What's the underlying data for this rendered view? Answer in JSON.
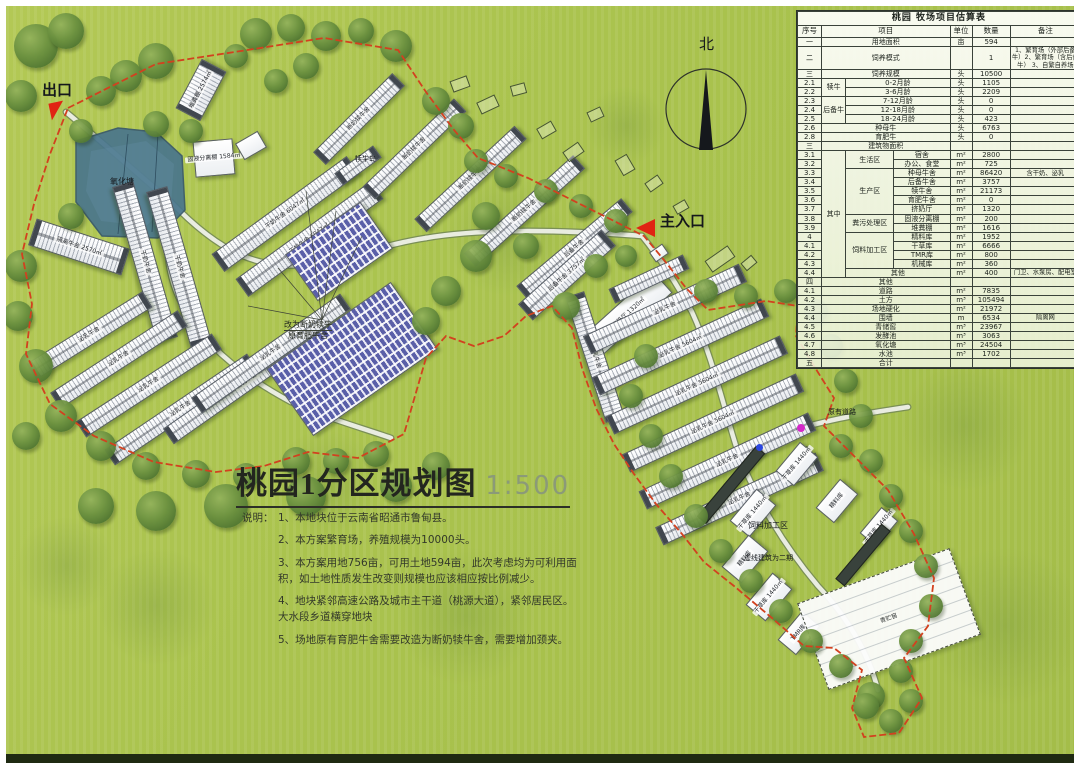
{
  "colors": {
    "boundary": "#d2411f",
    "pond": "#49758c",
    "background": "#a9c24c",
    "marker_red": "#e02413",
    "marker_magenta": "#d428c8",
    "marker_blue": "#2b46e0"
  },
  "title_block": {
    "title": "桃园1分区规划图",
    "scale": "1:500",
    "notes_label": "说明：",
    "notes": [
      "1、本地块位于云南省昭通市鲁甸县。",
      "2、本方案繁育场，养殖规模为10000头。",
      "3、本方案用地756亩，可用土地594亩，此次考虑均为可利用面积，如土地性质发生改变则规模也应该相应按比例减少。",
      "4、地块紧邻高速公路及城市主干道（桃源大道），紧邻居民区。\n大水段乡道横穿地块",
      "5、场地原有育肥牛舍需要改造为断奶犊牛舍，需要增加颈夹。"
    ]
  },
  "estimate_table": {
    "title": "桃园 牧场项目估算表",
    "headers": [
      "序号",
      "项目",
      "单位",
      "数量",
      "备注"
    ],
    "rows": [
      {
        "no": "一",
        "cells": [
          [
            "用地面积",
            3,
            1
          ]
        ],
        "unit": "亩",
        "qty": "594",
        "note": ""
      },
      {
        "no": "二",
        "cells": [
          [
            "饲养模式",
            3,
            1
          ]
        ],
        "unit": "",
        "qty": "1",
        "note": "1、繁育场（外部后备牛）2、繁育场（含后备牛） 3、自繁自养场"
      },
      {
        "no": "三",
        "cells": [
          [
            "饲养规模",
            3,
            1
          ]
        ],
        "unit": "头",
        "qty": "10500",
        "note": ""
      },
      {
        "no": "2.1",
        "cells": [
          [
            "犊牛",
            1,
            2
          ],
          [
            "0-2月龄",
            2,
            1
          ]
        ],
        "unit": "头",
        "qty": "1105",
        "note": ""
      },
      {
        "no": "2.2",
        "cells": [
          [
            "3-6月龄",
            2,
            1
          ]
        ],
        "unit": "头",
        "qty": "2209",
        "note": ""
      },
      {
        "no": "2.3",
        "cells": [
          [
            "后备牛",
            1,
            3
          ],
          [
            "7-12月龄",
            2,
            1
          ]
        ],
        "unit": "头",
        "qty": "0",
        "note": ""
      },
      {
        "no": "2.4",
        "cells": [
          [
            "12-18月龄",
            2,
            1
          ]
        ],
        "unit": "头",
        "qty": "0",
        "note": ""
      },
      {
        "no": "2.5",
        "cells": [
          [
            "18-24月龄",
            2,
            1
          ]
        ],
        "unit": "头",
        "qty": "423",
        "note": ""
      },
      {
        "no": "2.6",
        "cells": [
          [
            "种母牛",
            3,
            1
          ]
        ],
        "unit": "头",
        "qty": "6763",
        "note": ""
      },
      {
        "no": "2.8",
        "cells": [
          [
            "育肥牛",
            3,
            1
          ]
        ],
        "unit": "头",
        "qty": "0",
        "note": ""
      },
      {
        "no": "三",
        "cells": [
          [
            "建筑物面积",
            3,
            1
          ]
        ],
        "unit": "",
        "qty": "",
        "note": ""
      },
      {
        "no": "3.1",
        "cells": [
          [
            "其中",
            1,
            14
          ],
          [
            "生活区",
            1,
            2
          ],
          [
            "宿舍",
            1,
            1
          ]
        ],
        "unit": "m²",
        "qty": "2800",
        "note": ""
      },
      {
        "no": "3.2",
        "cells": [
          [
            "办公、食堂",
            1,
            1
          ]
        ],
        "unit": "m²",
        "qty": "725",
        "note": ""
      },
      {
        "no": "3.3",
        "cells": [
          [
            "生产区",
            1,
            5
          ],
          [
            "种母牛舍",
            1,
            1
          ]
        ],
        "unit": "m²",
        "qty": "86420",
        "note": "含干奶、泌乳"
      },
      {
        "no": "3.4",
        "cells": [
          [
            "后备牛舍",
            1,
            1
          ]
        ],
        "unit": "m²",
        "qty": "3757",
        "note": ""
      },
      {
        "no": "3.5",
        "cells": [
          [
            "犊牛舍",
            1,
            1
          ]
        ],
        "unit": "m²",
        "qty": "21173",
        "note": ""
      },
      {
        "no": "3.6",
        "cells": [
          [
            "育肥牛舍",
            1,
            1
          ]
        ],
        "unit": "m²",
        "qty": "0",
        "note": ""
      },
      {
        "no": "3.7",
        "cells": [
          [
            "挤奶厅",
            1,
            1
          ]
        ],
        "unit": "m²",
        "qty": "1320",
        "note": ""
      },
      {
        "no": "3.8",
        "cells": [
          [
            "粪污处理区",
            1,
            2
          ],
          [
            "固液分离棚",
            1,
            1
          ]
        ],
        "unit": "m²",
        "qty": "200",
        "note": ""
      },
      {
        "no": "3.9",
        "cells": [
          [
            "堆粪棚",
            1,
            1
          ]
        ],
        "unit": "m²",
        "qty": "1616",
        "note": ""
      },
      {
        "no": "4",
        "cells": [
          [
            "饲料加工区",
            1,
            4
          ],
          [
            "精料库",
            1,
            1
          ]
        ],
        "unit": "m²",
        "qty": "1952",
        "note": ""
      },
      {
        "no": "4.1",
        "cells": [
          [
            "干草库",
            1,
            1
          ]
        ],
        "unit": "m²",
        "qty": "6666",
        "note": ""
      },
      {
        "no": "4.2",
        "cells": [
          [
            "TMR库",
            1,
            1
          ]
        ],
        "unit": "m²",
        "qty": "800",
        "note": ""
      },
      {
        "no": "4.3",
        "cells": [
          [
            "机械库",
            1,
            1
          ]
        ],
        "unit": "m²",
        "qty": "360",
        "note": ""
      },
      {
        "no": "4.4",
        "cells": [
          [
            "其他",
            2,
            1
          ]
        ],
        "unit": "m²",
        "qty": "400",
        "note": "门卫、水泵房、配电室"
      },
      {
        "no": "四",
        "cells": [
          [
            "其他",
            3,
            1
          ]
        ],
        "unit": "",
        "qty": "",
        "note": ""
      },
      {
        "no": "4.1",
        "cells": [
          [
            "道路",
            3,
            1
          ]
        ],
        "unit": "m²",
        "qty": "7835",
        "note": ""
      },
      {
        "no": "4.2",
        "cells": [
          [
            "土方",
            3,
            1
          ]
        ],
        "unit": "m³",
        "qty": "105494",
        "note": ""
      },
      {
        "no": "4.3",
        "cells": [
          [
            "场地硬化",
            3,
            1
          ]
        ],
        "unit": "m²",
        "qty": "21972",
        "note": ""
      },
      {
        "no": "4.4",
        "cells": [
          [
            "围墙",
            3,
            1
          ]
        ],
        "unit": "m",
        "qty": "6534",
        "note": "隔离网"
      },
      {
        "no": "4.5",
        "cells": [
          [
            "青储窖",
            3,
            1
          ]
        ],
        "unit": "m³",
        "qty": "23967",
        "note": ""
      },
      {
        "no": "4.6",
        "cells": [
          [
            "发酵池",
            3,
            1
          ]
        ],
        "unit": "m³",
        "qty": "3063",
        "note": ""
      },
      {
        "no": "4.7",
        "cells": [
          [
            "氧化塘",
            3,
            1
          ]
        ],
        "unit": "m³",
        "qty": "24504",
        "note": ""
      },
      {
        "no": "4.8",
        "cells": [
          [
            "水池",
            3,
            1
          ]
        ],
        "unit": "m³",
        "qty": "1702",
        "note": ""
      },
      {
        "no": "五",
        "cells": [
          [
            "合计",
            3,
            1
          ]
        ],
        "unit": "",
        "qty": "",
        "note": ""
      }
    ]
  },
  "map": {
    "labels": [
      {
        "name": "exit-label",
        "text": "出口",
        "x": 36,
        "y": 76,
        "fs": 15,
        "bold": true
      },
      {
        "name": "main-entrance-label",
        "text": "主入口",
        "x": 654,
        "y": 207,
        "fs": 15,
        "bold": true
      },
      {
        "name": "north-label",
        "text": "北",
        "x": 693,
        "y": 30,
        "fs": 15,
        "bold": false
      },
      {
        "name": "pond-label",
        "text": "氧化塘",
        "x": 104,
        "y": 172,
        "fs": 8,
        "bold": false
      },
      {
        "name": "calf-island-label",
        "text": "犊牛岛",
        "x": 349,
        "y": 150,
        "fs": 7,
        "bold": false
      },
      {
        "name": "existing-road-label",
        "text": "原有道路",
        "x": 822,
        "y": 403,
        "fs": 7,
        "bold": false
      },
      {
        "name": "feed-area-label",
        "text": "饲料加工区",
        "x": 742,
        "y": 516,
        "fs": 8,
        "bold": false
      },
      {
        "name": "phase2-label",
        "text": "虚线建筑为二期",
        "x": 738,
        "y": 549,
        "fs": 7,
        "bold": false
      }
    ],
    "annotation": {
      "line1": "改为断奶犊牛",
      "line2": "原育肥牛舍",
      "x": 278,
      "y": 314
    },
    "buildings": [
      {
        "x": 167,
        "y": 70,
        "w": 54,
        "h": 26,
        "r": -62,
        "s": "barn",
        "l": "堆粪棚 2574㎡"
      },
      {
        "x": 188,
        "y": 134,
        "w": 38,
        "h": 34,
        "r": -5,
        "s": "plain",
        "l": "固液分离棚 1584㎡"
      },
      {
        "x": 232,
        "y": 130,
        "w": 24,
        "h": 17,
        "r": -30,
        "s": "plain",
        "l": ""
      },
      {
        "x": 196,
        "y": 197,
        "w": 165,
        "h": 20,
        "r": -36,
        "s": "barn",
        "l": "干奶牛舍 6047㎡"
      },
      {
        "x": 220,
        "y": 222,
        "w": 165,
        "h": 20,
        "r": -36,
        "s": "barn",
        "l": "干奶牛舍 6047㎡"
      },
      {
        "x": 328,
        "y": 152,
        "w": 46,
        "h": 13,
        "r": -36,
        "s": "barn",
        "l": ""
      },
      {
        "x": 24,
        "y": 227,
        "w": 96,
        "h": 26,
        "r": 18,
        "s": "barn",
        "l": "隔离牛舍 2570㎡"
      },
      {
        "x": 58,
        "y": 245,
        "w": 160,
        "h": 20,
        "r": 74,
        "s": "barn",
        "l": "干奶牛舍"
      },
      {
        "x": 92,
        "y": 250,
        "w": 160,
        "h": 20,
        "r": 74,
        "s": "barn",
        "l": "干奶牛舍"
      },
      {
        "x": 15,
        "y": 320,
        "w": 135,
        "h": 17,
        "r": -32,
        "s": "barn",
        "l": "泌乳牛舍"
      },
      {
        "x": 37,
        "y": 344,
        "w": 150,
        "h": 17,
        "r": -33,
        "s": "barn",
        "l": "泌乳牛舍"
      },
      {
        "x": 62,
        "y": 370,
        "w": 160,
        "h": 17,
        "r": -33,
        "s": "barn",
        "l": "泌乳牛舍"
      },
      {
        "x": 89,
        "y": 394,
        "w": 170,
        "h": 17,
        "r": -34,
        "s": "barn",
        "l": "泌乳牛舍"
      },
      {
        "x": 145,
        "y": 366,
        "w": 190,
        "h": 17,
        "r": -35,
        "s": "barn",
        "l": "泌乳牛舍"
      },
      {
        "x": 174,
        "y": 338,
        "w": 180,
        "h": 17,
        "r": -35,
        "s": "barn",
        "l": "泌乳牛舍"
      },
      {
        "x": 270,
        "y": 312,
        "w": 150,
        "h": 80,
        "r": -35,
        "s": "hutch",
        "l": ""
      },
      {
        "x": 287,
        "y": 217,
        "w": 90,
        "h": 55,
        "r": -35,
        "s": "hutch",
        "l": ""
      },
      {
        "x": 297,
        "y": 104,
        "w": 110,
        "h": 16,
        "r": -45,
        "s": "barn",
        "l": "断奶犊牛舍"
      },
      {
        "x": 345,
        "y": 134,
        "w": 125,
        "h": 16,
        "r": -44,
        "s": "barn",
        "l": "断奶犊牛舍"
      },
      {
        "x": 396,
        "y": 164,
        "w": 135,
        "h": 16,
        "r": -43,
        "s": "barn",
        "l": "断奶犊牛舍"
      },
      {
        "x": 445,
        "y": 196,
        "w": 145,
        "h": 16,
        "r": -42,
        "s": "barn",
        "l": "断奶犊牛舍"
      },
      {
        "x": 500,
        "y": 234,
        "w": 135,
        "h": 16,
        "r": -40,
        "s": "barn",
        "l": "后备牛舍"
      },
      {
        "x": 505,
        "y": 258,
        "w": 110,
        "h": 20,
        "r": -42,
        "s": "barn",
        "l": "后备牛舍 3757㎡"
      },
      {
        "x": 577,
        "y": 293,
        "w": 90,
        "h": 26,
        "r": -42,
        "s": "plain",
        "l": "挤奶厅 1320㎡"
      },
      {
        "x": 645,
        "y": 241,
        "w": 14,
        "h": 10,
        "r": -35,
        "s": "plain",
        "l": ""
      },
      {
        "x": 523,
        "y": 341,
        "w": 130,
        "h": 18,
        "r": 72,
        "s": "barn",
        "l": "泌乳牛舍"
      },
      {
        "x": 602,
        "y": 265,
        "w": 80,
        "h": 14,
        "r": -25,
        "s": "barn",
        "l": ""
      },
      {
        "x": 573,
        "y": 293,
        "w": 170,
        "h": 18,
        "r": -25,
        "s": "barn",
        "l": "泌乳牛舍"
      },
      {
        "x": 581,
        "y": 331,
        "w": 185,
        "h": 18,
        "r": -25,
        "s": "barn",
        "l": "泌乳牛舍 5604㎡"
      },
      {
        "x": 595,
        "y": 369,
        "w": 190,
        "h": 18,
        "r": -25,
        "s": "barn",
        "l": "泌乳牛舍 5604㎡"
      },
      {
        "x": 611,
        "y": 407,
        "w": 190,
        "h": 18,
        "r": -25,
        "s": "barn",
        "l": "泌乳牛舍 5604㎡"
      },
      {
        "x": 628,
        "y": 445,
        "w": 185,
        "h": 18,
        "r": -25,
        "s": "barn",
        "l": "泌乳牛舍"
      },
      {
        "x": 645,
        "y": 483,
        "w": 175,
        "h": 18,
        "r": -25,
        "s": "barn",
        "l": "泌乳牛舍"
      },
      {
        "x": 772,
        "y": 446,
        "w": 36,
        "h": 22,
        "r": -50,
        "s": "plain",
        "l": "干草库 1440㎡"
      },
      {
        "x": 812,
        "y": 483,
        "w": 36,
        "h": 22,
        "r": -50,
        "s": "plain",
        "l": "精料库"
      },
      {
        "x": 856,
        "y": 510,
        "w": 32,
        "h": 20,
        "r": -50,
        "s": "plain",
        "l": "干草库 1440㎡"
      },
      {
        "x": 726,
        "y": 494,
        "w": 40,
        "h": 24,
        "r": -50,
        "s": "plain",
        "l": "干草库 1440㎡"
      },
      {
        "x": 718,
        "y": 540,
        "w": 40,
        "h": 24,
        "r": -50,
        "s": "plain",
        "l": "精料库"
      },
      {
        "x": 742,
        "y": 578,
        "w": 40,
        "h": 24,
        "r": -50,
        "s": "plain",
        "l": "干草库 1440㎡"
      },
      {
        "x": 774,
        "y": 615,
        "w": 36,
        "h": 22,
        "r": -50,
        "s": "plain",
        "l": "TMR库"
      },
      {
        "x": 679,
        "y": 473,
        "w": 90,
        "h": 10,
        "r": -50,
        "s": "dark",
        "l": ""
      },
      {
        "x": 821,
        "y": 543,
        "w": 70,
        "h": 10,
        "r": -50,
        "s": "dark",
        "l": ""
      },
      {
        "x": 802,
        "y": 567,
        "w": 160,
        "h": 90,
        "r": -20,
        "s": "dashed",
        "l": "青贮窖"
      }
    ]
  }
}
